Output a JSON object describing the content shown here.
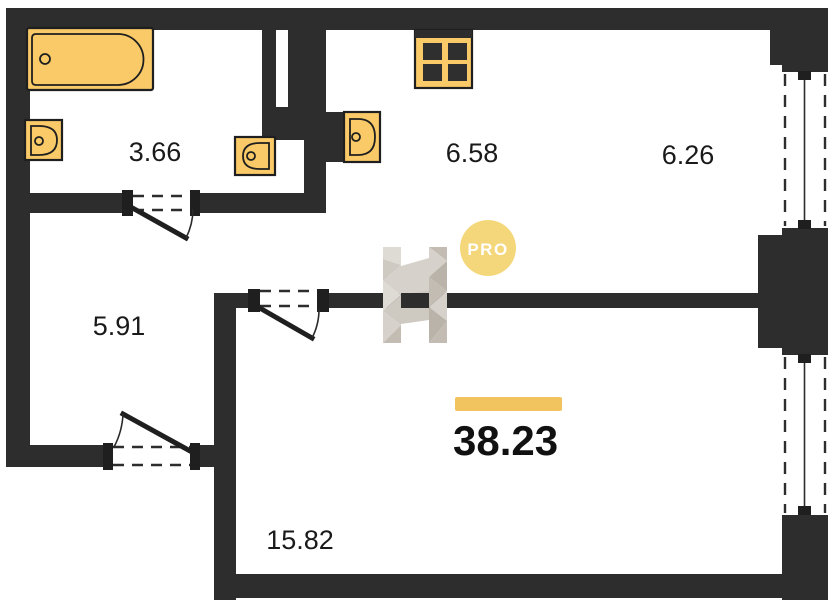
{
  "plan": {
    "type": "apartment-floor-plan",
    "badge": {
      "label": "PRO"
    },
    "total": {
      "area": "38.23"
    },
    "rooms": [
      {
        "name": "bathroom",
        "area": "3.66"
      },
      {
        "name": "kitchen",
        "area": "6.58"
      },
      {
        "name": "room",
        "area": "6.26"
      },
      {
        "name": "hallway",
        "area": "5.91"
      },
      {
        "name": "living-room",
        "area": "15.82"
      }
    ],
    "fixtures": [
      "bathtub-icon",
      "bathroom-sink-icon",
      "toilet-sink-icon",
      "kitchen-sink-icon",
      "stove-icon"
    ],
    "windows_count": 2,
    "doors_count": 3,
    "colors": {
      "wall": "#2d2d2d",
      "fixture_fill": "#f9ca67",
      "accent_bar": "#f2c45f",
      "badge_bg": "#f5d77b",
      "badge_text": "#ffffff",
      "label_text": "#1a1a1a",
      "watermark_light": "#dedbd5",
      "watermark_dark": "#c2bcb3"
    }
  }
}
